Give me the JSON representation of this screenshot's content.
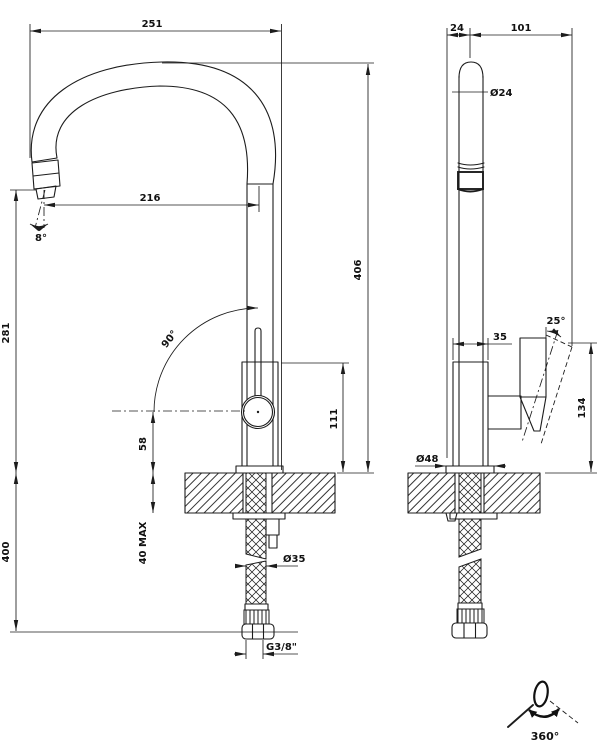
{
  "drawing": {
    "front_view": {
      "dim_total_width": "251",
      "dim_spout_reach": "216",
      "dim_spout_height": "281",
      "angle_spout_tilt": "8°",
      "angle_handle_travel": "90°",
      "dim_spout_outlet_to_deck": "58",
      "dim_deck_thickness_max": "40 MAX",
      "dim_hose_length": "400",
      "dia_shank": "Ø35",
      "thread_connection": "G3/8\"",
      "dim_body_height": "111",
      "dim_height_above_deck": "406"
    },
    "side_view": {
      "dim_spout_axis_to_front": "24",
      "dim_spout_axis_to_handle": "101",
      "dia_spout_tube": "Ø24",
      "dim_body_depth": "35",
      "angle_handle_tilt": "25°",
      "dim_handle_height": "134",
      "dia_base": "Ø48"
    },
    "legend": {
      "swivel_range": "360°"
    },
    "colors": {
      "line": "#1c1c1c",
      "background": "#ffffff"
    }
  }
}
